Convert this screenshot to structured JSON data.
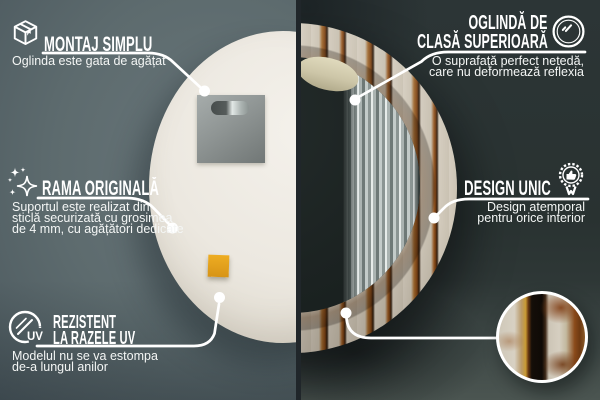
{
  "infographic": {
    "montaj": {
      "icon": "package-box-icon",
      "title": "MONTAJ SIMPLU",
      "subtitle": "Oglinda este gata de agățat"
    },
    "oglinda": {
      "icon": "round-mirror-icon",
      "title_line1": "OGLINDĂ DE",
      "title_line2": "CLASĂ SUPERIOARĂ",
      "subtitle_line1": "O suprafață perfect netedă,",
      "subtitle_line2": "care nu deformează reflexia"
    },
    "rama": {
      "icon": "sparkles-icon",
      "title": "RAMA ORIGINALĂ",
      "subtitle_line1": "Suportul este realizat din",
      "subtitle_line2": "sticlă securizată cu grosimea",
      "subtitle_line3": "de 4 mm, cu agățători dedicate"
    },
    "design": {
      "icon": "award-badge-icon",
      "title": "DESIGN UNIC",
      "subtitle_line1": "Design atemporal",
      "subtitle_line2": "pentru orice interior"
    },
    "uv": {
      "icon": "uv-protection-icon",
      "title_line1": "REZISTENT",
      "title_line2": "LA RAZELE UV",
      "subtitle_line1": "Modelul nu se va estompa",
      "subtitle_line2": "de-a lungul anilor",
      "badge_text": "UV"
    },
    "colors": {
      "callout_line": "#ffffff",
      "left_wall": "#5b696c",
      "right_wall": "#2b3433",
      "mirror_back": "#ece8e0",
      "wood_rust": "#8a4a1e",
      "wood_paint": "#d2cbbd",
      "divider": "#20262a",
      "sticker_orange": "#e3a51e"
    }
  }
}
